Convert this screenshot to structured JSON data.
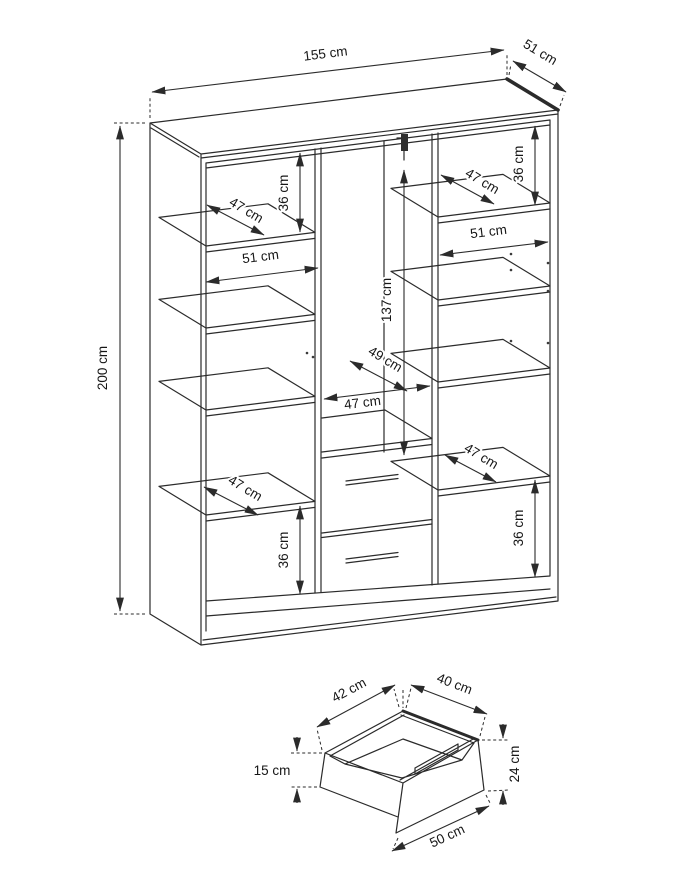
{
  "page": {
    "background": "#ffffff",
    "ink_color": "#2b2b2b",
    "figure_type": "furniture-dimension-diagram"
  },
  "wardrobe": {
    "overall": {
      "width": "155 cm",
      "depth": "51 cm",
      "height": "200 cm"
    },
    "labels": {
      "width_top": "155 cm",
      "depth_top": "51 cm",
      "height_left": "200 cm",
      "left_gap_top": "36 cm",
      "left_shelf_depth_top": "47 cm",
      "left_width": "51 cm",
      "left_shelf_depth_bottom": "47 cm",
      "left_gap_bottom": "36 cm",
      "mid_height": "137 cm",
      "mid_depth": "49 cm",
      "mid_width": "47 cm",
      "right_gap_top": "36 cm",
      "right_shelf_depth_top": "47 cm",
      "right_width": "51 cm",
      "right_shelf_depth_bottom": "47 cm",
      "right_gap_bottom": "36 cm"
    }
  },
  "drawer": {
    "labels": {
      "inner_depth": "42 cm",
      "inner_width": "40 cm",
      "side_height": "15 cm",
      "front_height": "24 cm",
      "front_width": "50 cm"
    }
  }
}
